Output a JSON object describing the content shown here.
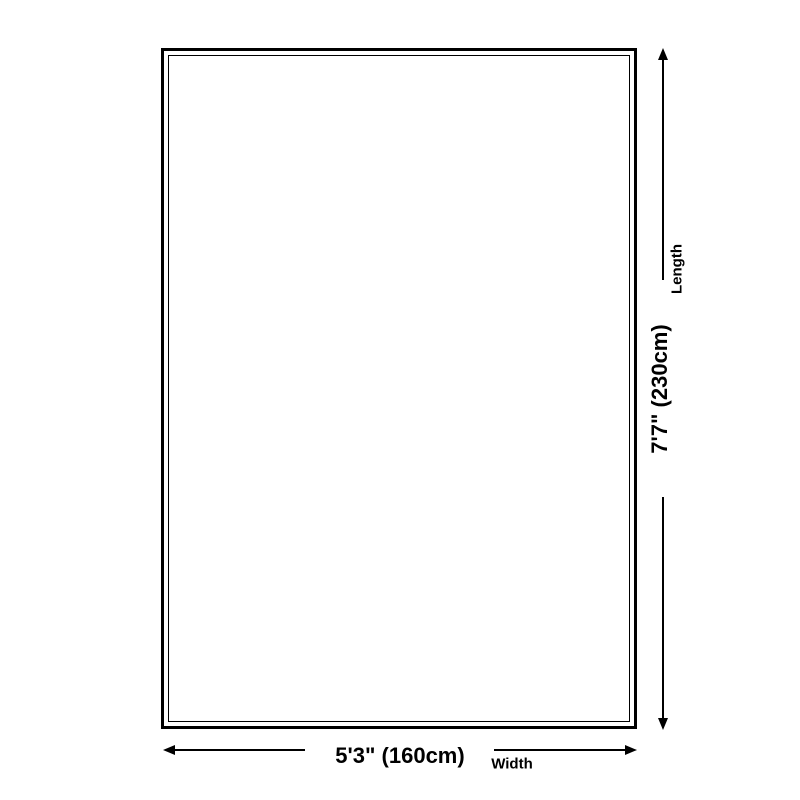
{
  "diagram": {
    "shape": "rectangle",
    "background_color": "#ffffff",
    "line_color": "#000000",
    "length": {
      "value": "7'7\" (230cm)",
      "label": "Length"
    },
    "width": {
      "value": "5'3\" (160cm)",
      "label": "Width"
    }
  }
}
